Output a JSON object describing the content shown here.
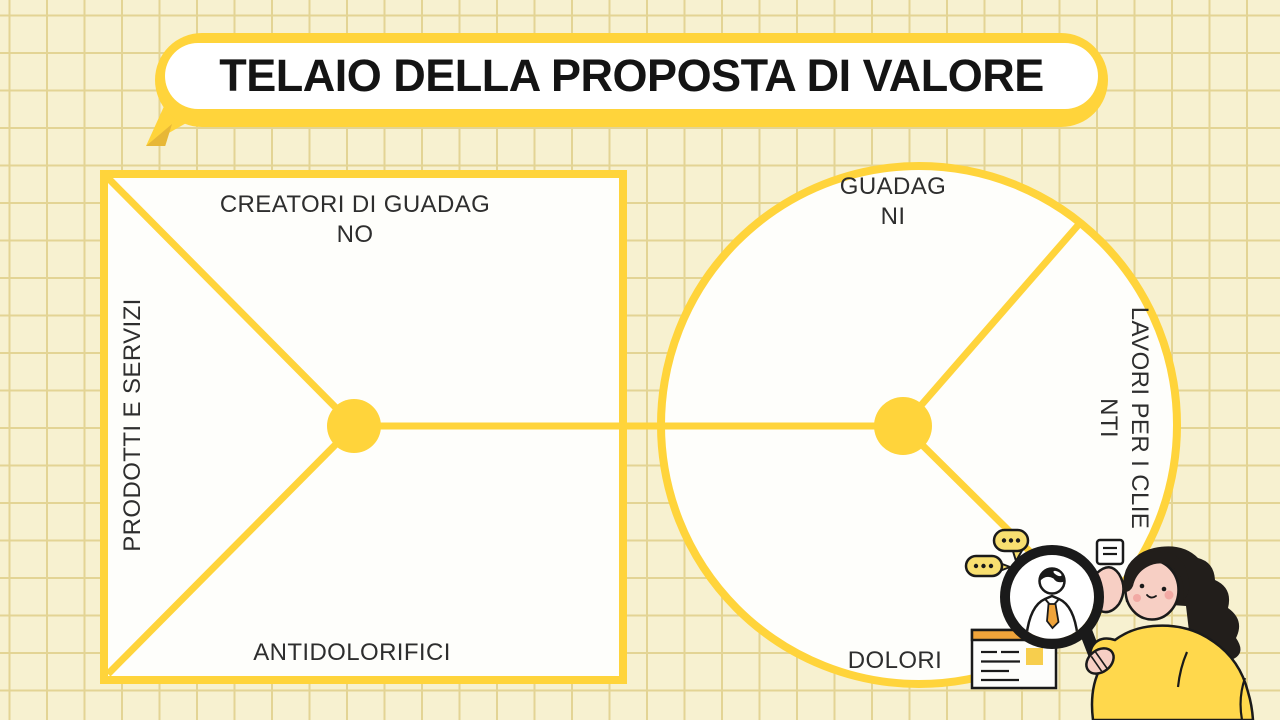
{
  "title": {
    "text": "TELAIO DELLA PROPOSTA DI VALORE"
  },
  "value_map_square": {
    "top_label_lines": [
      "CREATORI DI GUADAG",
      "NO"
    ],
    "left_label": "PRODOTTI E SERVIZI",
    "bottom_label": "ANTIDOLORIFICI"
  },
  "customer_circle": {
    "top_label_lines": [
      "GUADAG",
      "NI"
    ],
    "right_label_lines": [
      "LAVORI PER I CLIE",
      "NTI"
    ],
    "bottom_label": "DOLORI"
  },
  "colors": {
    "accent_yellow": "#FFD43B",
    "background_cream": "#F7F1D0",
    "grid_line": "#E3D494",
    "panel_white": "#FEFEFB",
    "text_dark": "#2E2E2E",
    "title_black": "#141414",
    "illustration_black": "#1A1A1A",
    "illustration_pink": "#F7CFC4",
    "blush_pink": "#F2A9A4",
    "illustration_orange": "#F0A43A",
    "bubble_yellow": "#F8DF70",
    "sweater_yellow": "#FFD84C",
    "doc_square_yellow": "#F7CE4D"
  },
  "icons": [
    "speech-bubble-icon",
    "speech-bubble-icon",
    "note-icon",
    "document-icon",
    "magnifier-icon",
    "person-in-magnifier-icon",
    "woman-illustration"
  ]
}
